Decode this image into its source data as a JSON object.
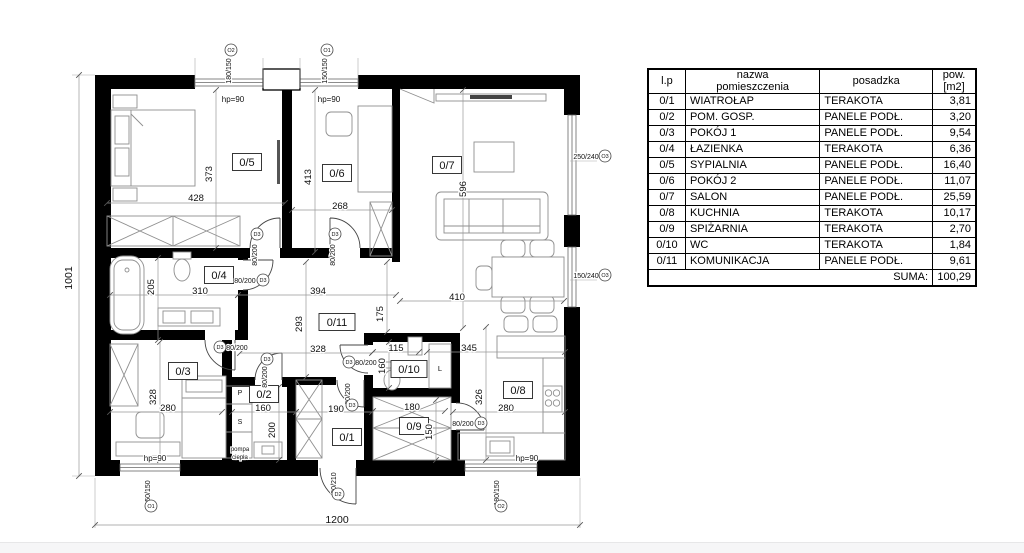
{
  "table": {
    "headers": {
      "lp": "l.p",
      "name": "nazwa\npomieszczenia",
      "floor": "posadzka",
      "area": "pow.\n[m2]"
    },
    "rows": [
      {
        "lp": "0/1",
        "name": "WIATROŁAP",
        "floor": "TERAKOTA",
        "area": "3,81"
      },
      {
        "lp": "0/2",
        "name": "POM. GOSP.",
        "floor": "PANELE PODŁ.",
        "area": "3,20"
      },
      {
        "lp": "0/3",
        "name": "POKÓJ 1",
        "floor": "PANELE PODŁ.",
        "area": "9,54"
      },
      {
        "lp": "0/4",
        "name": "ŁAZIENKA",
        "floor": "TERAKOTA",
        "area": "6,36"
      },
      {
        "lp": "0/5",
        "name": "SYPIALNIA",
        "floor": "PANELE PODŁ.",
        "area": "16,40"
      },
      {
        "lp": "0/6",
        "name": "POKÓJ 2",
        "floor": "PANELE PODŁ.",
        "area": "11,07"
      },
      {
        "lp": "0/7",
        "name": "SALON",
        "floor": "PANELE PODŁ.",
        "area": "25,59"
      },
      {
        "lp": "0/8",
        "name": "KUCHNIA",
        "floor": "TERAKOTA",
        "area": "10,17"
      },
      {
        "lp": "0/9",
        "name": "SPIŻARNIA",
        "floor": "TERAKOTA",
        "area": "2,70"
      },
      {
        "lp": "0/10",
        "name": "WC",
        "floor": "TERAKOTA",
        "area": "1,84"
      },
      {
        "lp": "0/11",
        "name": "KOMUNIKACJA",
        "floor": "PANELE PODŁ.",
        "area": "9,61"
      }
    ],
    "suma_label": "SUMA:",
    "suma_value": "100,29"
  },
  "plan": {
    "overall_dims": {
      "width_cm": "1200",
      "height_cm": "1001"
    },
    "room_labels": [
      {
        "t": "0/5",
        "x": 247,
        "y": 162
      },
      {
        "t": "0/6",
        "x": 337,
        "y": 173
      },
      {
        "t": "0/7",
        "x": 447,
        "y": 165
      },
      {
        "t": "0/4",
        "x": 219,
        "y": 275
      },
      {
        "t": "0/11",
        "x": 337,
        "y": 322
      },
      {
        "t": "0/3",
        "x": 183,
        "y": 371
      },
      {
        "t": "0/2",
        "x": 264,
        "y": 394
      },
      {
        "t": "0/1",
        "x": 347,
        "y": 437
      },
      {
        "t": "0/10",
        "x": 409,
        "y": 369
      },
      {
        "t": "0/9",
        "x": 414,
        "y": 426
      },
      {
        "t": "0/8",
        "x": 518,
        "y": 390
      }
    ],
    "dims": [
      {
        "t": "373",
        "x": 212,
        "y": 171,
        "r": -90
      },
      {
        "t": "428",
        "x": 196,
        "y": 198
      },
      {
        "t": "413",
        "x": 311,
        "y": 174,
        "r": -90
      },
      {
        "t": "268",
        "x": 340,
        "y": 206
      },
      {
        "t": "596",
        "x": 466,
        "y": 186,
        "r": -90
      },
      {
        "t": "410",
        "x": 457,
        "y": 297
      },
      {
        "t": "205",
        "x": 154,
        "y": 284,
        "r": -90
      },
      {
        "t": "310",
        "x": 200,
        "y": 291
      },
      {
        "t": "394",
        "x": 318,
        "y": 291
      },
      {
        "t": "293",
        "x": 302,
        "y": 321,
        "r": -90
      },
      {
        "t": "328",
        "x": 318,
        "y": 349
      },
      {
        "t": "175",
        "x": 383,
        "y": 311,
        "r": -90
      },
      {
        "t": "328",
        "x": 156,
        "y": 394,
        "r": -90
      },
      {
        "t": "280",
        "x": 168,
        "y": 408
      },
      {
        "t": "160",
        "x": 263,
        "y": 408
      },
      {
        "t": "200",
        "x": 275,
        "y": 427,
        "r": -90
      },
      {
        "t": "190",
        "x": 336,
        "y": 409
      },
      {
        "t": "115",
        "x": 396,
        "y": 348
      },
      {
        "t": "160",
        "x": 385,
        "y": 363,
        "r": -90
      },
      {
        "t": "180",
        "x": 412,
        "y": 407
      },
      {
        "t": "150",
        "x": 432,
        "y": 429,
        "r": -90
      },
      {
        "t": "345",
        "x": 469,
        "y": 348
      },
      {
        "t": "326",
        "x": 482,
        "y": 394,
        "r": -90
      },
      {
        "t": "280",
        "x": 506,
        "y": 408
      },
      {
        "t": "1001",
        "x": 72,
        "y": 275,
        "r": -90,
        "s": 10.5
      },
      {
        "t": "1200",
        "x": 337,
        "y": 520,
        "s": 10.5
      }
    ],
    "fractions": [
      {
        "t": "80/200",
        "x": 257,
        "y": 252,
        "r": -90
      },
      {
        "t": "80/200",
        "x": 335,
        "y": 252,
        "r": -90
      },
      {
        "t": "80/200",
        "x": 245,
        "y": 280
      },
      {
        "t": "80/200",
        "x": 237,
        "y": 347
      },
      {
        "t": "80/200",
        "x": 267,
        "y": 374,
        "r": -90
      },
      {
        "t": "80/200",
        "x": 366,
        "y": 362
      },
      {
        "t": "80/200",
        "x": 350,
        "y": 391,
        "r": -90
      },
      {
        "t": "80/200",
        "x": 463,
        "y": 423
      },
      {
        "t": "90/210",
        "x": 336,
        "y": 480,
        "r": -90
      },
      {
        "t": "150/150",
        "x": 150,
        "y": 490,
        "r": -90
      },
      {
        "t": "180/150",
        "x": 499,
        "y": 490,
        "r": -90
      },
      {
        "t": "180/150",
        "x": 231,
        "y": 68,
        "r": -90
      },
      {
        "t": "150/150",
        "x": 327,
        "y": 68,
        "r": -90
      },
      {
        "t": "250/240",
        "x": 586,
        "y": 156
      },
      {
        "t": "150/240",
        "x": 586,
        "y": 275
      }
    ],
    "marks": [
      {
        "t": "D3",
        "x": 257,
        "y": 234
      },
      {
        "t": "D3",
        "x": 335,
        "y": 234
      },
      {
        "t": "D3",
        "x": 263,
        "y": 280
      },
      {
        "t": "D3",
        "x": 220,
        "y": 347
      },
      {
        "t": "D3",
        "x": 267,
        "y": 359
      },
      {
        "t": "D3",
        "x": 349,
        "y": 362
      },
      {
        "t": "D3",
        "x": 352,
        "y": 405
      },
      {
        "t": "D3",
        "x": 481,
        "y": 423
      },
      {
        "t": "D2",
        "x": 338,
        "y": 494
      },
      {
        "t": "O1",
        "x": 151,
        "y": 506
      },
      {
        "t": "O2",
        "x": 501,
        "y": 506
      },
      {
        "t": "O2",
        "x": 231,
        "y": 50
      },
      {
        "t": "O1",
        "x": 327,
        "y": 50
      },
      {
        "t": "O3",
        "x": 605,
        "y": 156
      },
      {
        "t": "O3",
        "x": 605,
        "y": 275
      }
    ],
    "annotations": [
      {
        "t": "hp=90",
        "x": 233,
        "y": 99
      },
      {
        "t": "hp=90",
        "x": 329,
        "y": 99
      },
      {
        "t": "hp=90",
        "x": 155,
        "y": 458
      },
      {
        "t": "hp=90",
        "x": 527,
        "y": 458
      },
      {
        "t": "P",
        "x": 240,
        "y": 392,
        "s": 7
      },
      {
        "t": "S",
        "x": 240,
        "y": 421,
        "s": 7
      },
      {
        "t": "L",
        "x": 440,
        "y": 368,
        "s": 7.5
      },
      {
        "t": "pompa",
        "x": 240,
        "y": 448,
        "s": 6
      },
      {
        "t": "ciepła",
        "x": 240,
        "y": 456,
        "s": 6
      }
    ]
  }
}
